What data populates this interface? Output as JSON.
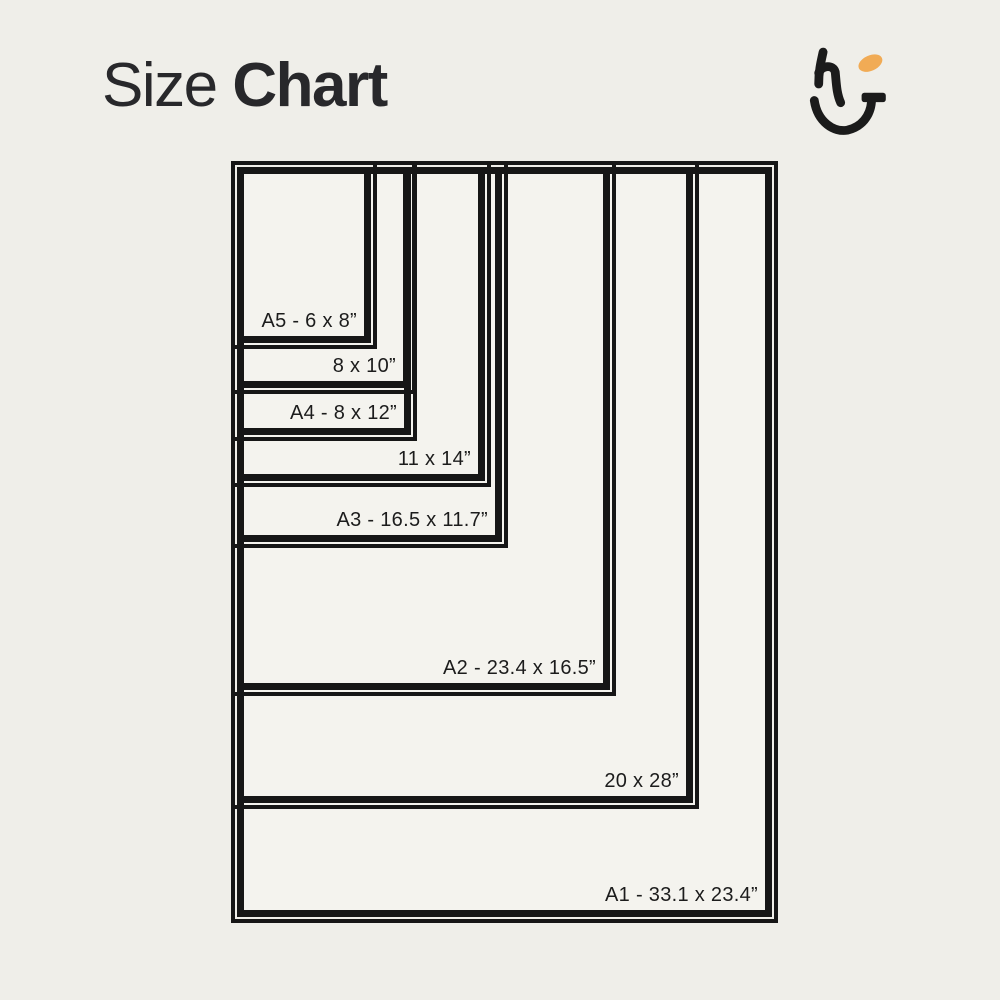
{
  "title": {
    "regular": "Size",
    "bold": "Chart"
  },
  "logo": {
    "name": "hj-monogram",
    "ink_color": "#1b1b1b",
    "accent_color": "#F1AB55"
  },
  "colors": {
    "background": "#efeee9",
    "chart_fill": "#f4f3ee",
    "line": "#161616",
    "text": "#1c1c1c",
    "title_text": "#28282b"
  },
  "chart": {
    "origin": {
      "left": 237,
      "top": 167
    },
    "sizes": [
      {
        "id": "a5",
        "label": "A5 - 6 x 8”",
        "width_in": 6,
        "height_in": 8,
        "px_w": 134,
        "px_h": 176
      },
      {
        "id": "8x10",
        "label": "8 x 10”",
        "width_in": 8,
        "height_in": 10,
        "px_w": 173,
        "px_h": 221
      },
      {
        "id": "a4",
        "label": "A4 - 8 x 12”",
        "width_in": 8,
        "height_in": 12,
        "px_w": 174,
        "px_h": 268
      },
      {
        "id": "11x14",
        "label": "11 x 14”",
        "width_in": 11,
        "height_in": 14,
        "px_w": 248,
        "px_h": 314
      },
      {
        "id": "a3",
        "label": "A3 - 16.5 x 11.7”",
        "width_in": 11.7,
        "height_in": 16.5,
        "px_w": 265,
        "px_h": 375
      },
      {
        "id": "a2",
        "label": "A2 - 23.4 x 16.5”",
        "width_in": 16.5,
        "height_in": 23.4,
        "px_w": 373,
        "px_h": 523
      },
      {
        "id": "20x28",
        "label": "20 x 28”",
        "width_in": 20,
        "height_in": 28,
        "px_w": 456,
        "px_h": 636
      },
      {
        "id": "a1",
        "label": "A1 - 33.1 x 23.4”",
        "width_in": 23.4,
        "height_in": 33.1,
        "px_w": 535,
        "px_h": 750
      }
    ]
  }
}
